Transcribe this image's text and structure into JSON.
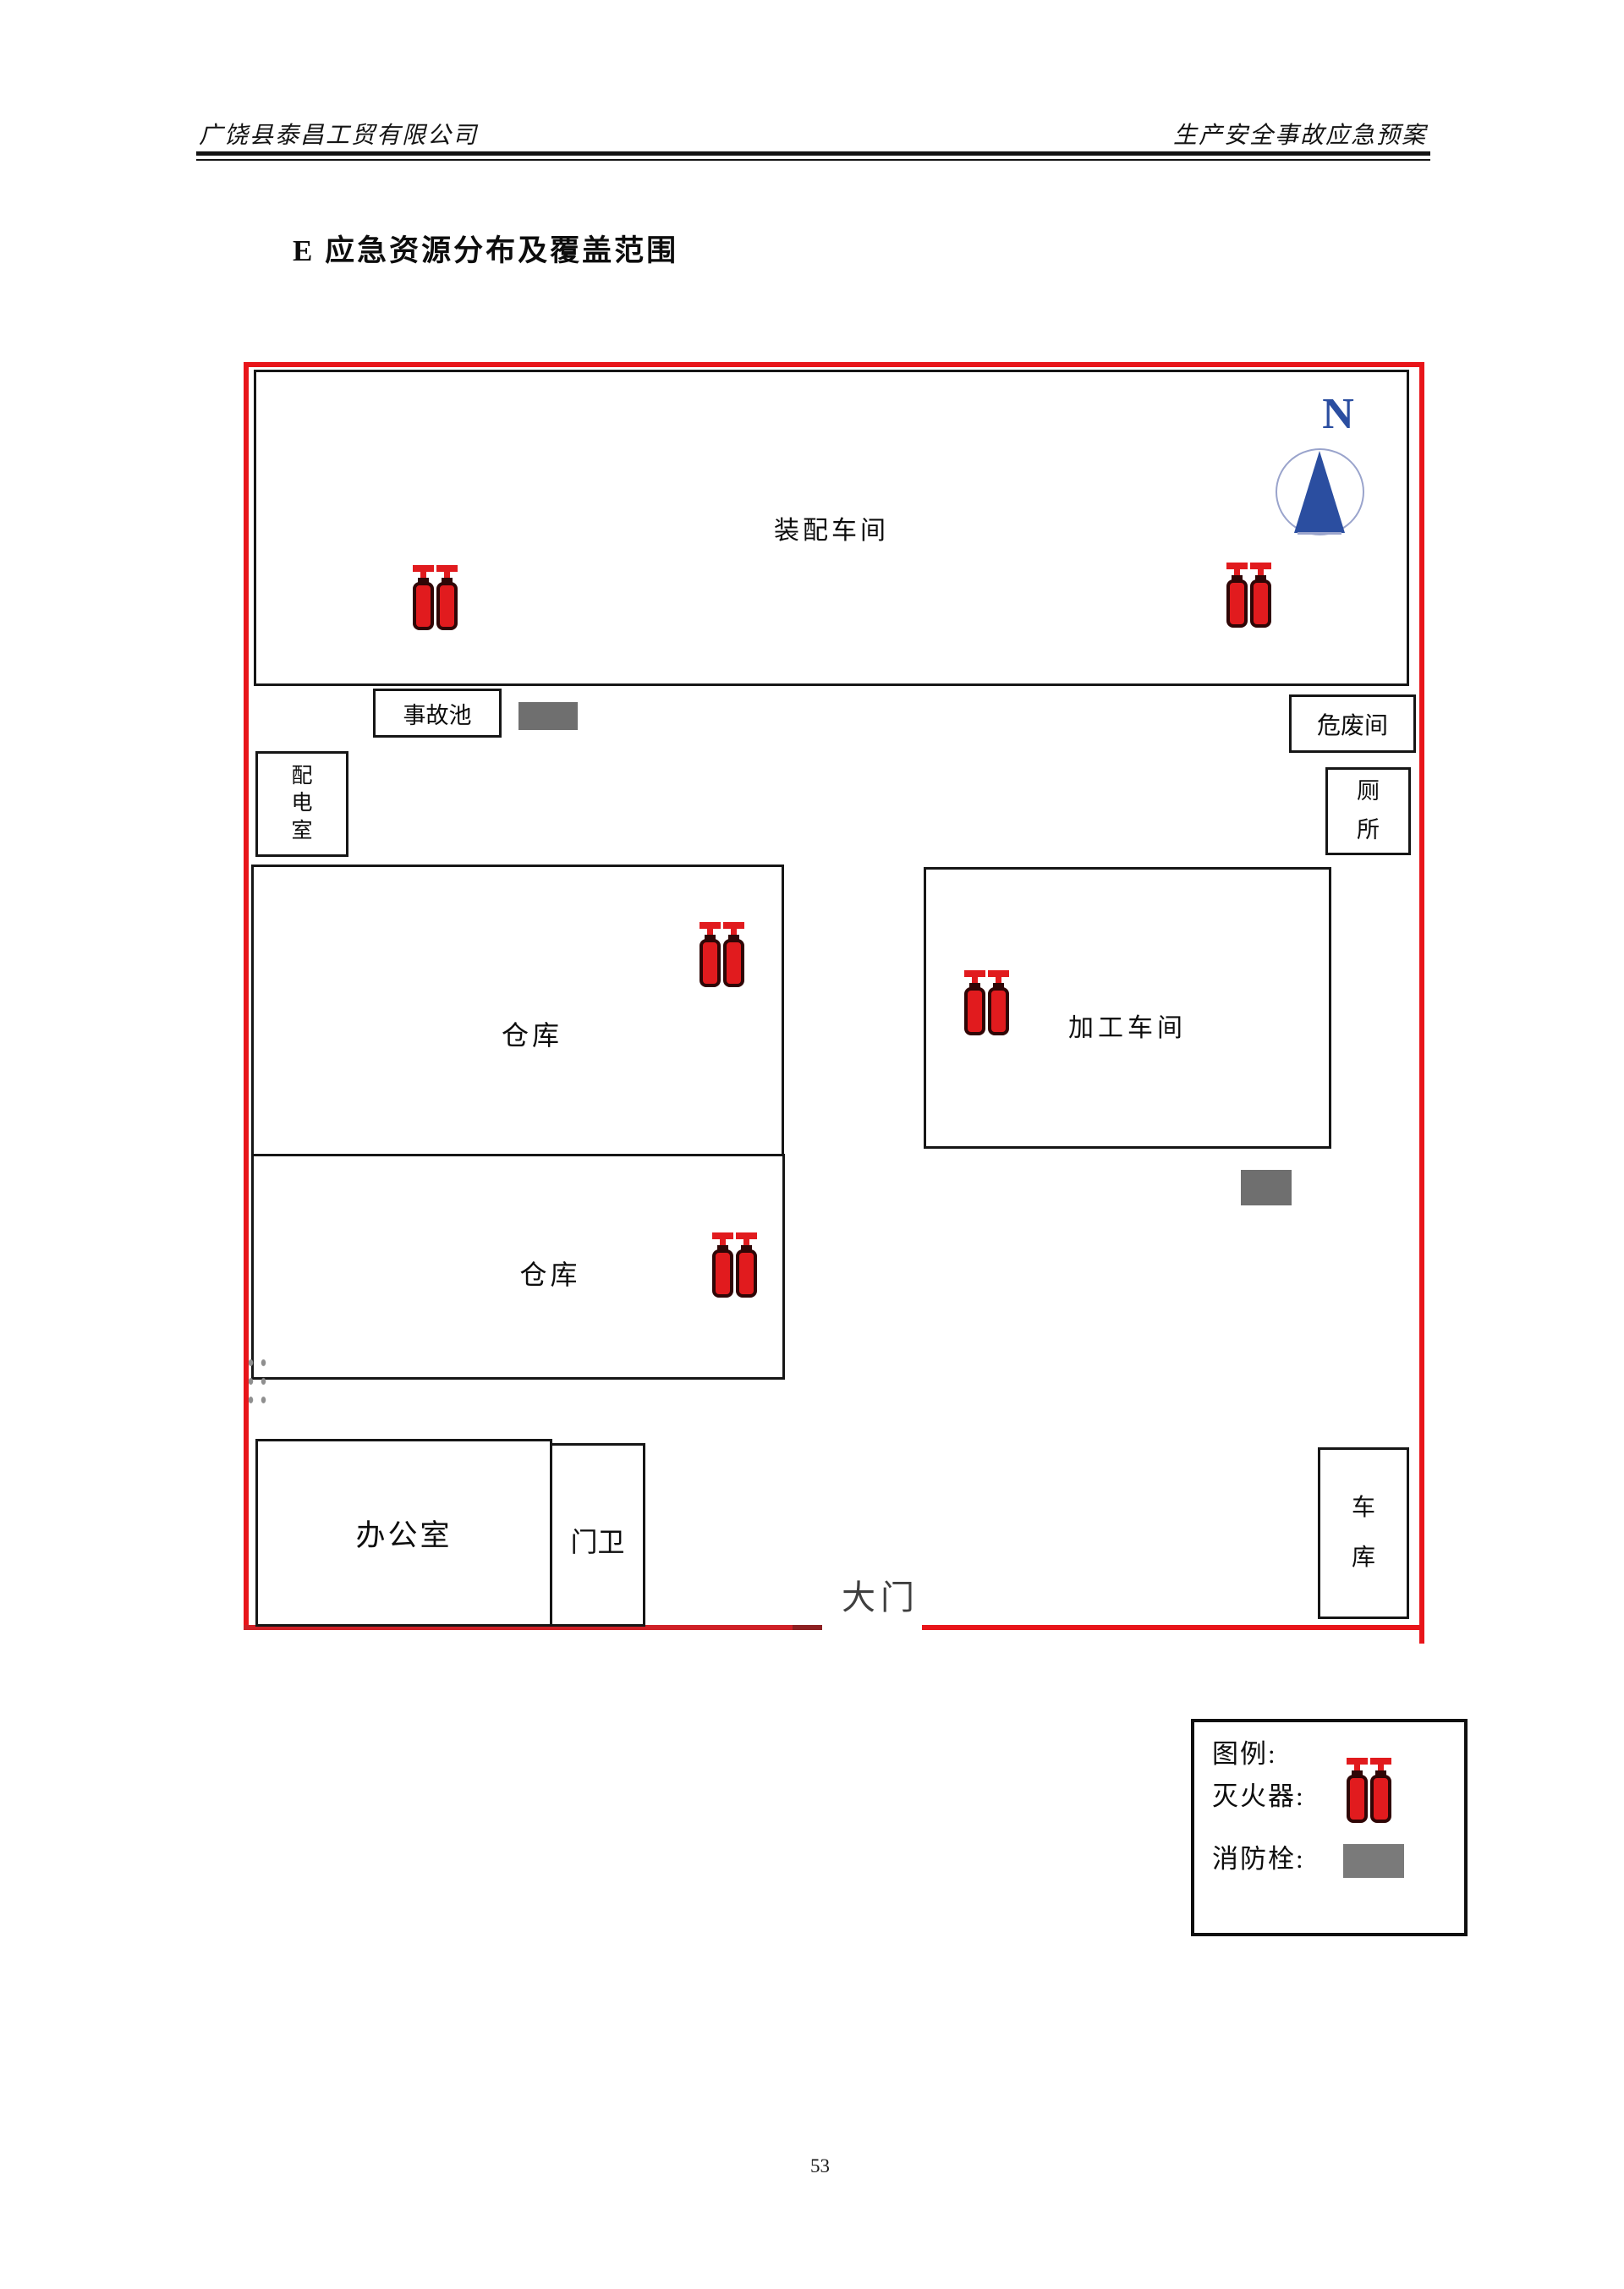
{
  "header": {
    "company": "广饶县泰昌工贸有限公司",
    "doc_title": "生产安全事故应急预案"
  },
  "section_title": "E 应急资源分布及覆盖范围",
  "plan": {
    "compass": {
      "letter": "N"
    },
    "rooms": {
      "assembly": "装配车间",
      "accident_pool": "事故池",
      "hazardous_waste": "危废间",
      "power_room": "配电室",
      "toilet": "厕所",
      "warehouse_upper": "仓库",
      "warehouse_lower": "仓库",
      "processing": "加工车间",
      "office": "办公室",
      "gate_guard": "门卫",
      "garage": "车库"
    },
    "gate_label": "大门",
    "icons": {
      "extinguisher": "fire-extinguisher-red-bottle-pair",
      "hydrant": "fire-hydrant-gray-rectangle",
      "compass": "north-arrow"
    }
  },
  "legend": {
    "title": "图例:",
    "extinguisher": "灭火器:",
    "hydrant": "消防栓:"
  },
  "page_number": "53",
  "colors": {
    "boundary_red": "#e8151a",
    "extinguisher_red": "#e11b1e",
    "hydrant_gray": "#6f6f6f",
    "compass_blue": "#2b4ea0"
  }
}
